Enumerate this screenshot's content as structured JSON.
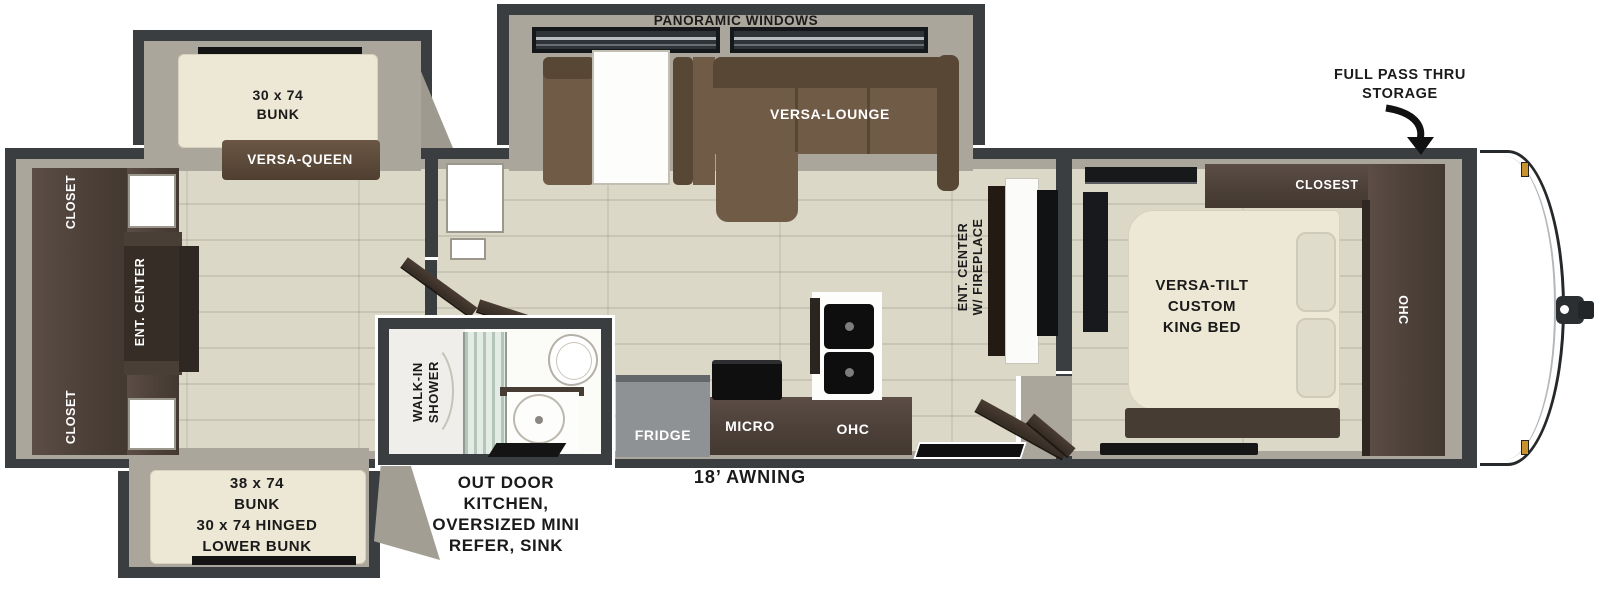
{
  "colors": {
    "wall": "#3b3e41",
    "lining": "#aba69b",
    "floor": "#dcd8c8",
    "floor_seam": "#c9c5b5",
    "cabinet_dark": "#4c4039",
    "cabinet_darker": "#352d26",
    "sofa": "#6f5b46",
    "sofa_dark": "#594736",
    "bed": "#ece8d5",
    "pillow": "#e0dccb",
    "fridge": "#8f9294",
    "counter_white": "#fdfdfb",
    "sink_black": "#0e0e0e",
    "flame": "#ef9b12",
    "glass": "#e2ebe4",
    "label_dark": "#1a1a1a",
    "label_light": "#ffffff",
    "cap_white": "#ffffff",
    "marker_amber": "#c8922e"
  },
  "floorplan": {
    "exterior": {
      "full_pass_thru": "FULL PASS THRU\nSTORAGE",
      "awning": "18’ AWNING",
      "outdoor_kitchen": "OUT DOOR\nKITCHEN,\nOVERSIZED MINI\nREFER, SINK"
    },
    "living": {
      "panoramic_windows": "PANORAMIC WINDOWS",
      "versa_lounge": "VERSA-LOUNGE",
      "ent_center_fireplace": "ENT. CENTER\nW/ FIREPLACE"
    },
    "kitchen": {
      "fridge": "FRIDGE",
      "micro": "MICRO",
      "ohc": "OHC"
    },
    "bathroom": {
      "walk_in_shower": "WALK-IN\nSHOWER"
    },
    "bedroom": {
      "king_bed": "VERSA-TILT\nCUSTOM\nKING BED",
      "closet": "CLOSEST",
      "ohc": "OHC"
    },
    "bunk_room": {
      "bunk_top": "30 x 74\nBUNK",
      "versa_queen": "VERSA-QUEEN",
      "closet_top": "CLOSET",
      "ent_center": "ENT. CENTER",
      "closet_bottom": "CLOSET",
      "bunk_bottom": "38 x 74\nBUNK\n30 x 74 HINGED\nLOWER BUNK"
    }
  }
}
